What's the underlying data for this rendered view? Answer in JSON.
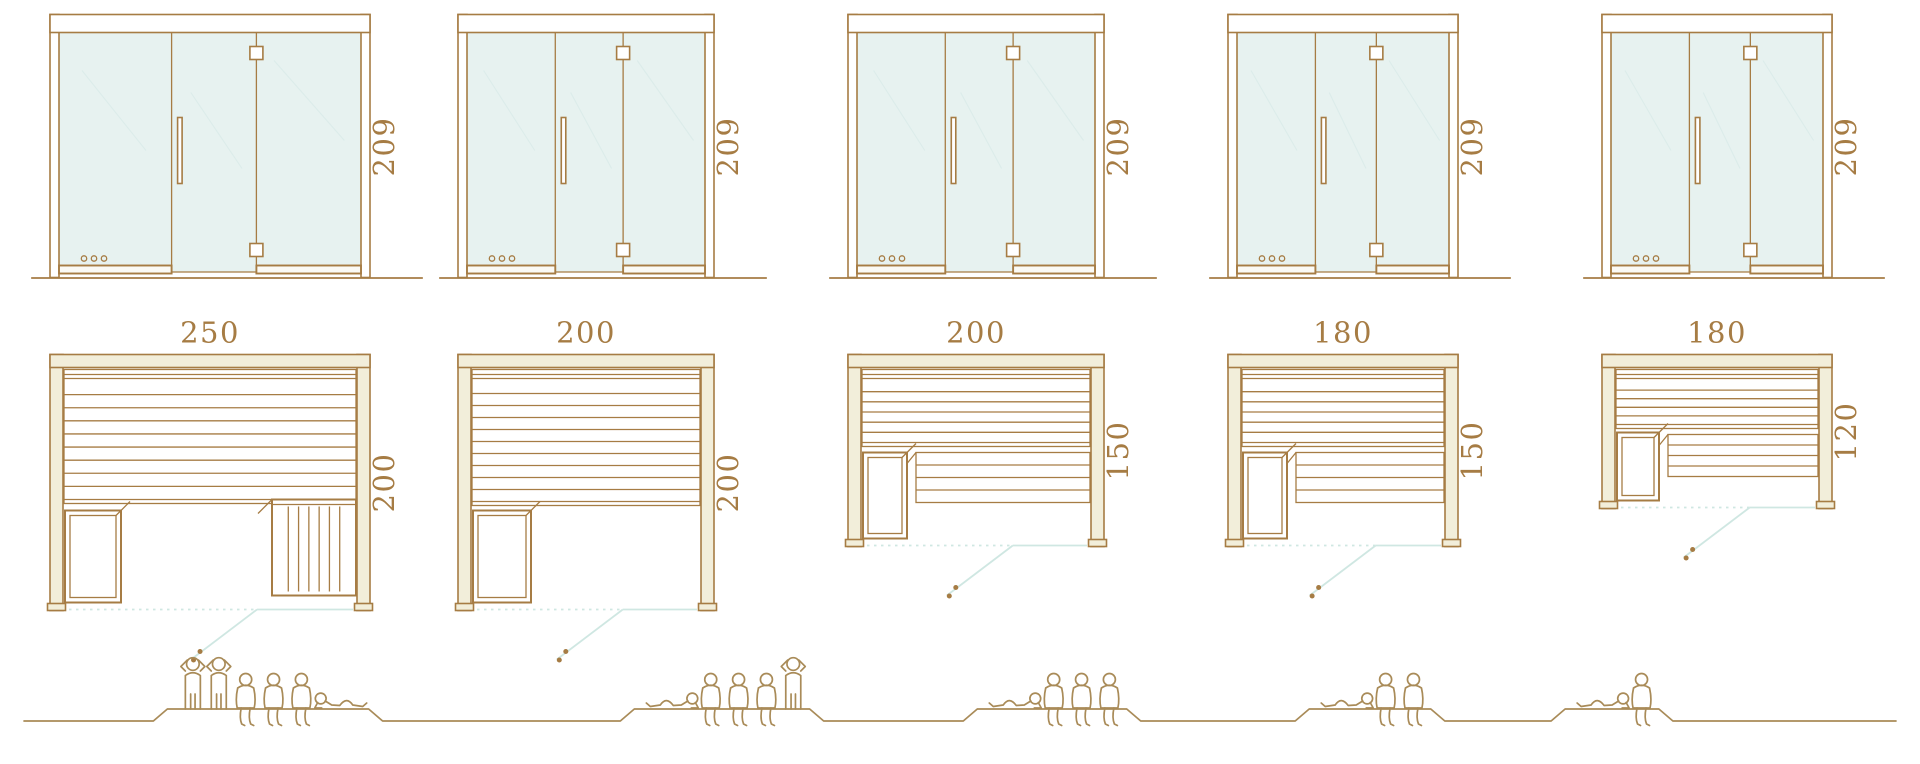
{
  "palette": {
    "line": "#a67c44",
    "text": "#a67c44",
    "glass_fill": "#e7f2f0",
    "wall_fill": "#f2eeda",
    "door_swing": "#cfe7e2",
    "people_line": "#a98b58",
    "background": "#ffffff"
  },
  "units": [
    {
      "id": "sauna-250x200",
      "front": {
        "height_label": "209"
      },
      "plan": {
        "width_label": "250",
        "depth_label": "200",
        "width_cm": 250,
        "depth_cm": 200
      },
      "features": {
        "door": "hinged-glass-door-right-hinges",
        "vents": "three-dots-bottom-left",
        "heater": "lattice-box-front-left",
        "upper_bench_slats": 8,
        "lower_bench": "vertical-slat-bench-front-right"
      },
      "capacity": {
        "people_total": 6,
        "figures": [
          "standing",
          "standing",
          "seated",
          "seated",
          "seated",
          "reclining"
        ]
      }
    },
    {
      "id": "sauna-200x200",
      "front": {
        "height_label": "209"
      },
      "plan": {
        "width_label": "200",
        "depth_label": "200",
        "width_cm": 200,
        "depth_cm": 200
      },
      "features": {
        "door": "hinged-glass-door-right-hinges",
        "vents": "three-dots-bottom-left",
        "heater": "lattice-box-front-left",
        "upper_bench_slats": 9,
        "lower_bench": "none"
      },
      "capacity": {
        "people_total": 5,
        "figures": [
          "reclining",
          "seated",
          "seated",
          "seated",
          "standing"
        ]
      }
    },
    {
      "id": "sauna-200x150",
      "front": {
        "height_label": "209"
      },
      "plan": {
        "width_label": "200",
        "depth_label": "150",
        "width_cm": 200,
        "depth_cm": 150
      },
      "features": {
        "door": "hinged-glass-door-right-hinges",
        "vents": "three-dots-bottom-left",
        "heater": "lattice-box-front-left",
        "upper_bench_slats": 5,
        "lower_bench": "horizontal-slat-bench-right-of-heater"
      },
      "capacity": {
        "people_total": 4,
        "figures": [
          "reclining",
          "seated",
          "seated",
          "seated"
        ]
      }
    },
    {
      "id": "sauna-180x150",
      "front": {
        "height_label": "209"
      },
      "plan": {
        "width_label": "180",
        "depth_label": "150",
        "width_cm": 180,
        "depth_cm": 150
      },
      "features": {
        "door": "hinged-glass-door-right-hinges",
        "vents": "three-dots-bottom-left",
        "heater": "lattice-box-front-left",
        "upper_bench_slats": 5,
        "lower_bench": "horizontal-slat-bench-right-of-heater"
      },
      "capacity": {
        "people_total": 3,
        "figures": [
          "reclining",
          "seated",
          "seated"
        ]
      }
    },
    {
      "id": "sauna-180x120",
      "front": {
        "height_label": "209"
      },
      "plan": {
        "width_label": "180",
        "depth_label": "120",
        "width_cm": 180,
        "depth_cm": 120
      },
      "features": {
        "door": "hinged-glass-door-right-hinges",
        "vents": "three-dots-bottom-left",
        "heater": "lattice-box-front-left",
        "upper_bench_slats": 4,
        "lower_bench": "horizontal-slat-bench-right-of-heater"
      },
      "capacity": {
        "people_total": 2,
        "figures": [
          "reclining",
          "seated"
        ]
      }
    }
  ]
}
